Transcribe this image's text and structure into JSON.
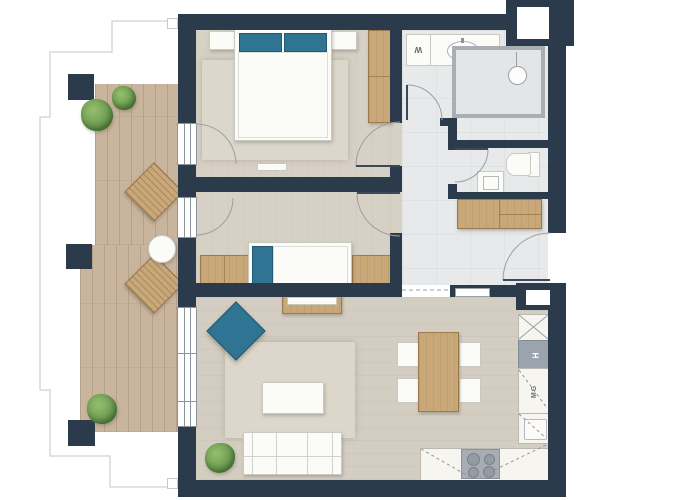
{
  "labels": {
    "washing_machine": "W",
    "oven": "H",
    "microwave": "MG"
  },
  "colors": {
    "wall_navy": "#2c3b4b",
    "balcony_wood": "#c9b59e",
    "furniture_wood": "#c8a878",
    "accent_blue": "#2f7492",
    "room_floor": "#d4cec2",
    "tile_floor": "#e8e9eb",
    "rug": "#dcd7cb",
    "kitchen_counter": "#f7f5ef",
    "plant_green": "#76a356"
  }
}
